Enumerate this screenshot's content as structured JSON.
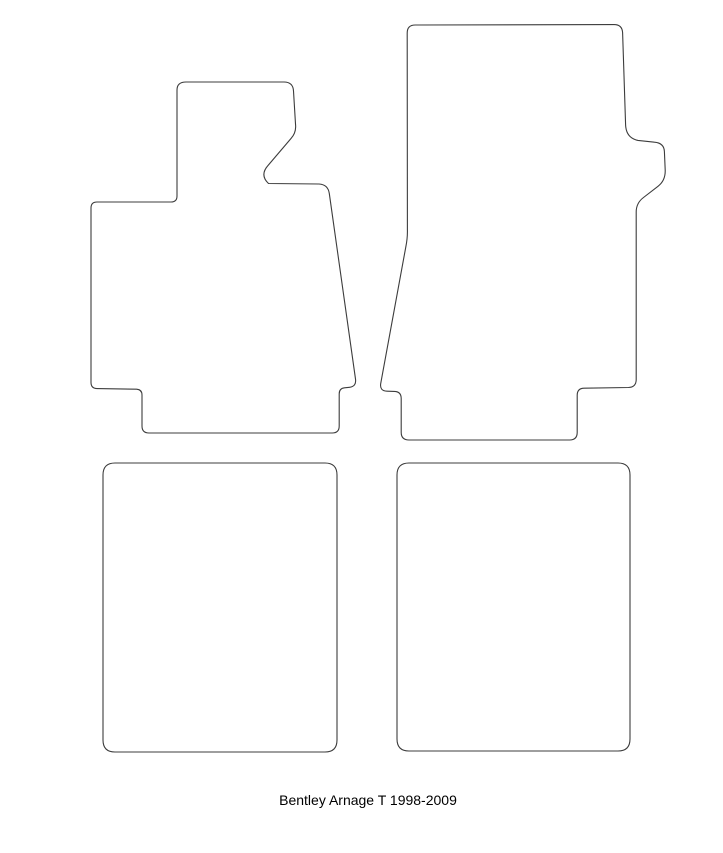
{
  "canvas": {
    "width": 723,
    "height": 853,
    "background": "#ffffff"
  },
  "stroke": {
    "color": "#3c3c3c",
    "width": 1.1,
    "fill": "#ffffff"
  },
  "caption": {
    "text": "Bentley Arnage T 1998-2009"
  },
  "mats": [
    {
      "id": "front-left-mat-outline",
      "label": "front left (driver) floor mat template with footrest tab and bottom heel extension",
      "path": "M 186 82 L 284 82 Q 293 82 293.5 91 L 295.5 124 Q 296.5 132.5 291 138.5 L 268 165.5 Q 259.5 175 268.5 183.5 L 319 184 Q 328 184.5 329.3 193.5 L 355.5 379 Q 356.5 386.5 349.5 387.3 L 344.5 387.8 Q 339.2 388.3 339.2 394 L 339.2 426 Q 339.2 433 332.2 433 L 149 433 Q 142 433 142 426 L 142 395 Q 142 389.6 136.6 389.2 L 97 388.6 Q 91 388.4 91 382.4 L 91 208 Q 91 202 97 202 L 171 202 Q 177 202 177 196 L 177 90 Q 177 82 186 82 Z"
    },
    {
      "id": "front-right-mat-outline",
      "label": "front right (passenger) floor mat template with side notch and bottom heel extension",
      "path": "M 415.2 25 L 614 24.6 Q 622 24.5 622.6 32.6 L 625.6 125 Q 626.2 138 638 140.4 L 654.5 142.2 Q 664 143 664.4 151.5 L 665.2 170 Q 665.6 180.5 658 186.3 L 643.5 197.5 Q 636.2 203 636.2 212 L 636.2 379.5 Q 636.2 387.2 628.5 387.5 L 584 388.2 Q 577.2 388.4 577.2 395.2 L 577.2 432.4 Q 577.2 440 569.6 440 L 409 440 Q 401.2 440 401.2 432.4 L 401.2 398.4 Q 401.2 391.6 394.4 391.4 L 387 391.2 Q 379.6 391 380.7 383.6 L 405.8 247 Q 407.6 238 407.4 230 L 407.2 33 Q 407.2 25 415.2 25 Z"
    },
    {
      "id": "rear-left-mat-outline",
      "label": "rear left floor mat template (rounded rectangle)",
      "path": "M 115 463 L 325 463 Q 337 463 337 475 L 337 740 Q 337 752 325 752 L 115 752 Q 103 752 103 740 L 103 475 Q 103 463 115 463 Z"
    },
    {
      "id": "rear-right-mat-outline",
      "label": "rear right floor mat template (rounded rectangle)",
      "path": "M 409 463 L 618 463 Q 630 463 630 475 L 630 739 Q 630 751 618 751 L 409 751 Q 397 751 397 739 L 397 475 Q 397 463 409 463 Z"
    }
  ]
}
